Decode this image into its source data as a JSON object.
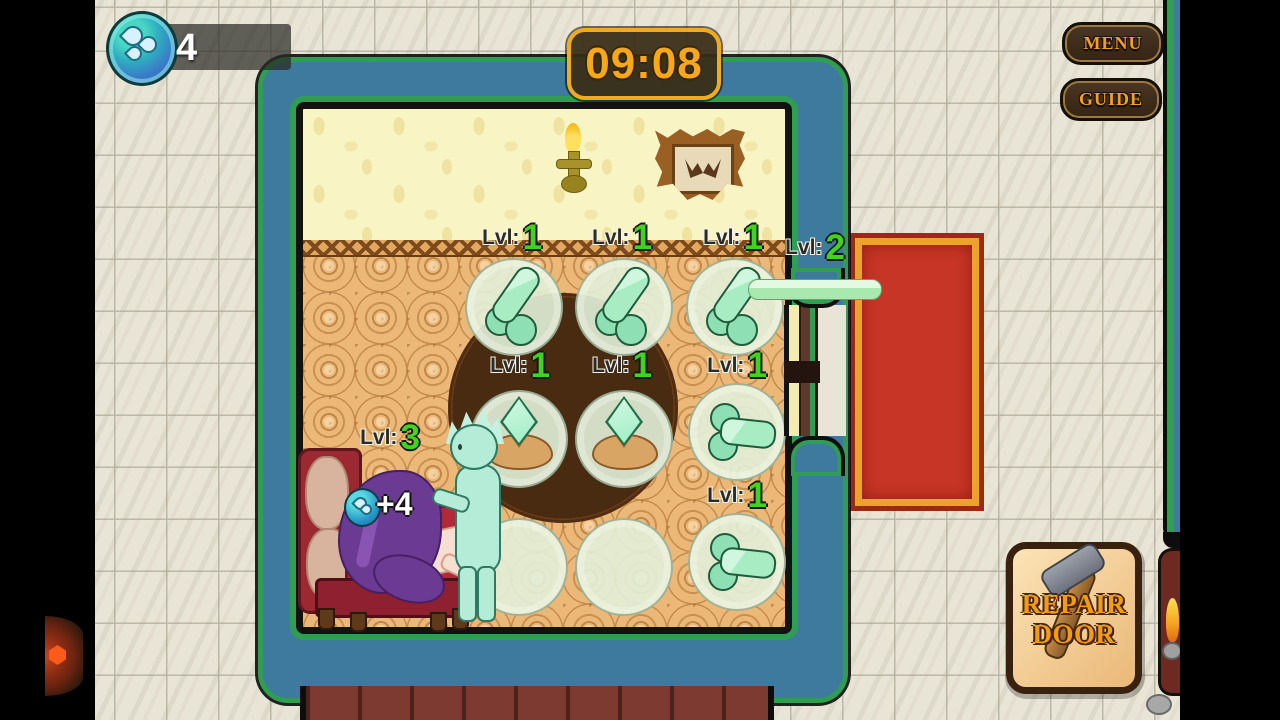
{
  "hud": {
    "water_counter": {
      "count": "4",
      "icon": "water-drops-icon"
    },
    "timer": {
      "value": "09:08"
    },
    "menu_label": "MENU",
    "guide_label": "GUIDE",
    "repair_button": {
      "line1": "REPAIR",
      "line2": "DOOR",
      "icon": "hammer-icon"
    }
  },
  "room": {
    "levels": [
      {
        "slot": "turret-row1-col1",
        "prefix": "Lvl:",
        "value": "1"
      },
      {
        "slot": "turret-row1-col2",
        "prefix": "Lvl:",
        "value": "1"
      },
      {
        "slot": "turret-row1-col3",
        "prefix": "Lvl:",
        "value": "1"
      },
      {
        "slot": "door-turret",
        "prefix": "Lvl:",
        "value": "2"
      },
      {
        "slot": "crystal-row2-col1",
        "prefix": "Lvl:",
        "value": "1"
      },
      {
        "slot": "crystal-row2-col2",
        "prefix": "Lvl:",
        "value": "1"
      },
      {
        "slot": "side-turret-row2-col3",
        "prefix": "Lvl:",
        "value": "1"
      },
      {
        "slot": "side-turret-row3-col3",
        "prefix": "Lvl:",
        "value": "1"
      },
      {
        "slot": "couch-unit",
        "prefix": "Lvl:",
        "value": "3"
      }
    ],
    "gain_popup": "+4"
  },
  "colors": {
    "level_green": "#3fd41e",
    "timer_gold": "#f4a81a",
    "wall_blue": "#3d7a9e",
    "wall_green": "#2f9e52",
    "door_red": "#c63525",
    "door_gold": "#eca32e",
    "plate_green": "#e2f0d8"
  }
}
